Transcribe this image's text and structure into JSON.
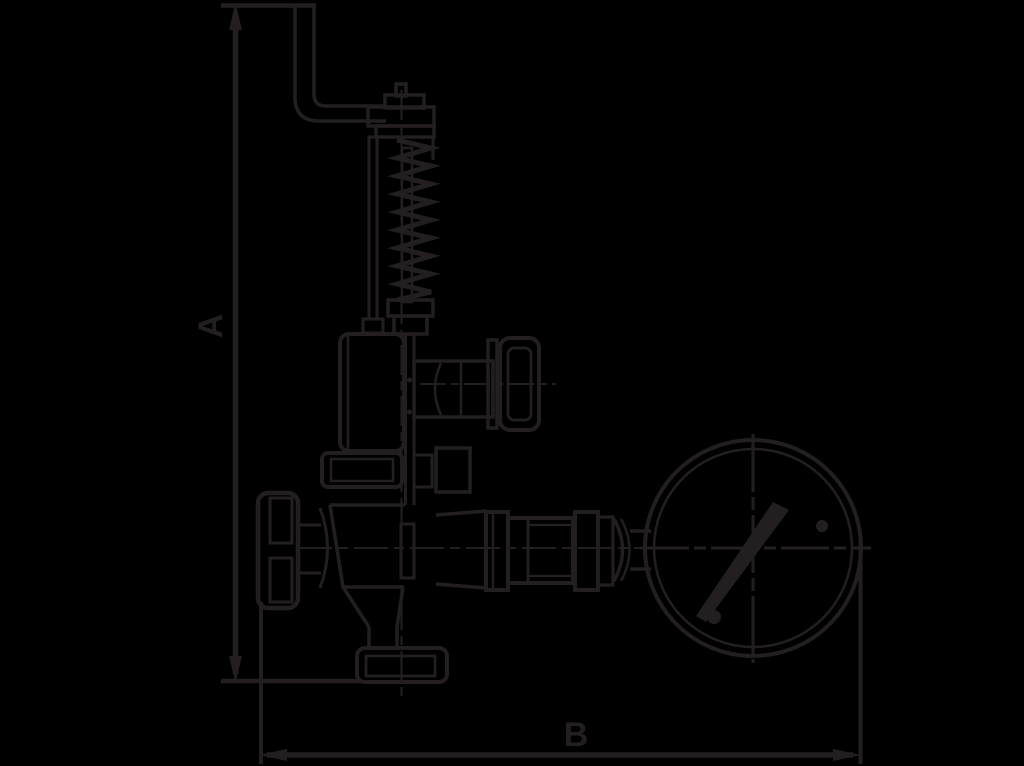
{
  "figure": {
    "kind": "technical-dimension-drawing",
    "subject": "safety relief valve with lifting lever, spring housing, shut-off handwheels, piping unions and pressure gauge",
    "labels": {
      "height_dimension": "A",
      "width_dimension": "B"
    },
    "colors": {
      "background": "#000000",
      "ink": "#231f20"
    }
  }
}
